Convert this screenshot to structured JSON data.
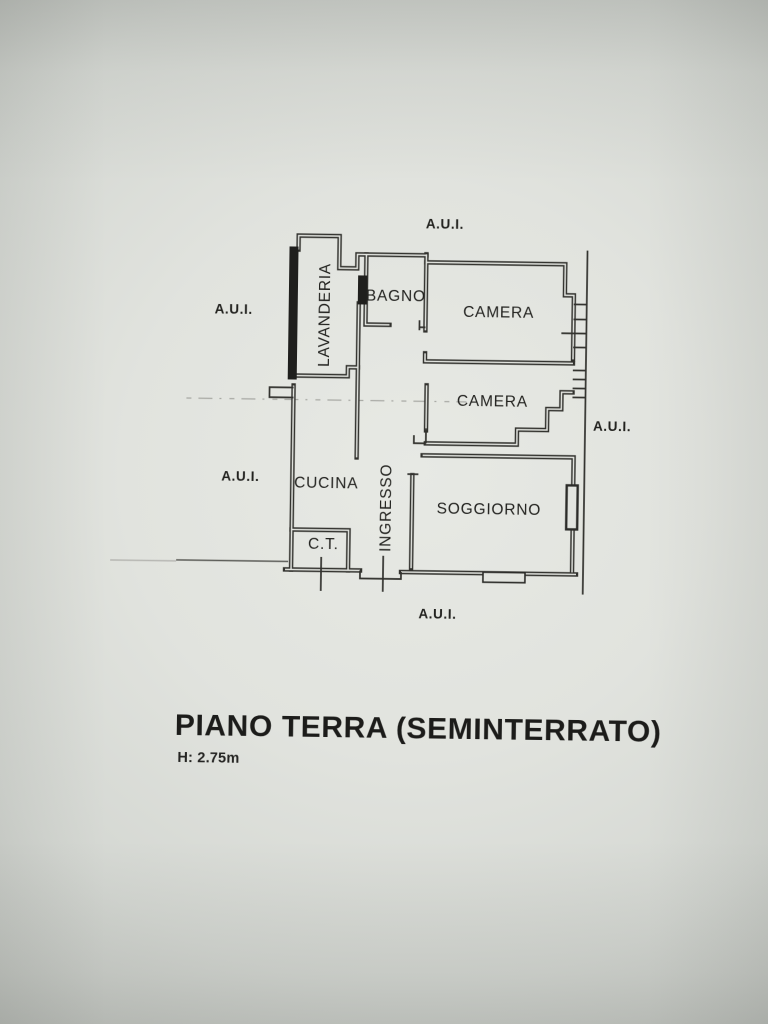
{
  "plan": {
    "rooms": [
      {
        "name": "LAVANDERIA",
        "orientation": "vertical"
      },
      {
        "name": "BAGNO",
        "orientation": "horizontal"
      },
      {
        "name": "CAMERA",
        "orientation": "horizontal"
      },
      {
        "name": "CAMERA",
        "orientation": "horizontal"
      },
      {
        "name": "CUCINA",
        "orientation": "horizontal"
      },
      {
        "name": "INGRESSO",
        "orientation": "vertical"
      },
      {
        "name": "SOGGIORNO",
        "orientation": "horizontal"
      },
      {
        "name": "C.T.",
        "orientation": "horizontal"
      }
    ],
    "exterior_labels": {
      "top": "A.U.I.",
      "left_upper": "A.U.I.",
      "left_lower": "A.U.I.",
      "right": "A.U.I.",
      "bottom": "A.U.I."
    }
  },
  "caption": {
    "title": "PIANO TERRA (SEMINTERRATO)",
    "height_note": "H: 2.75m"
  },
  "colors": {
    "paper": "#e2e4df",
    "ink": "#32322e"
  }
}
